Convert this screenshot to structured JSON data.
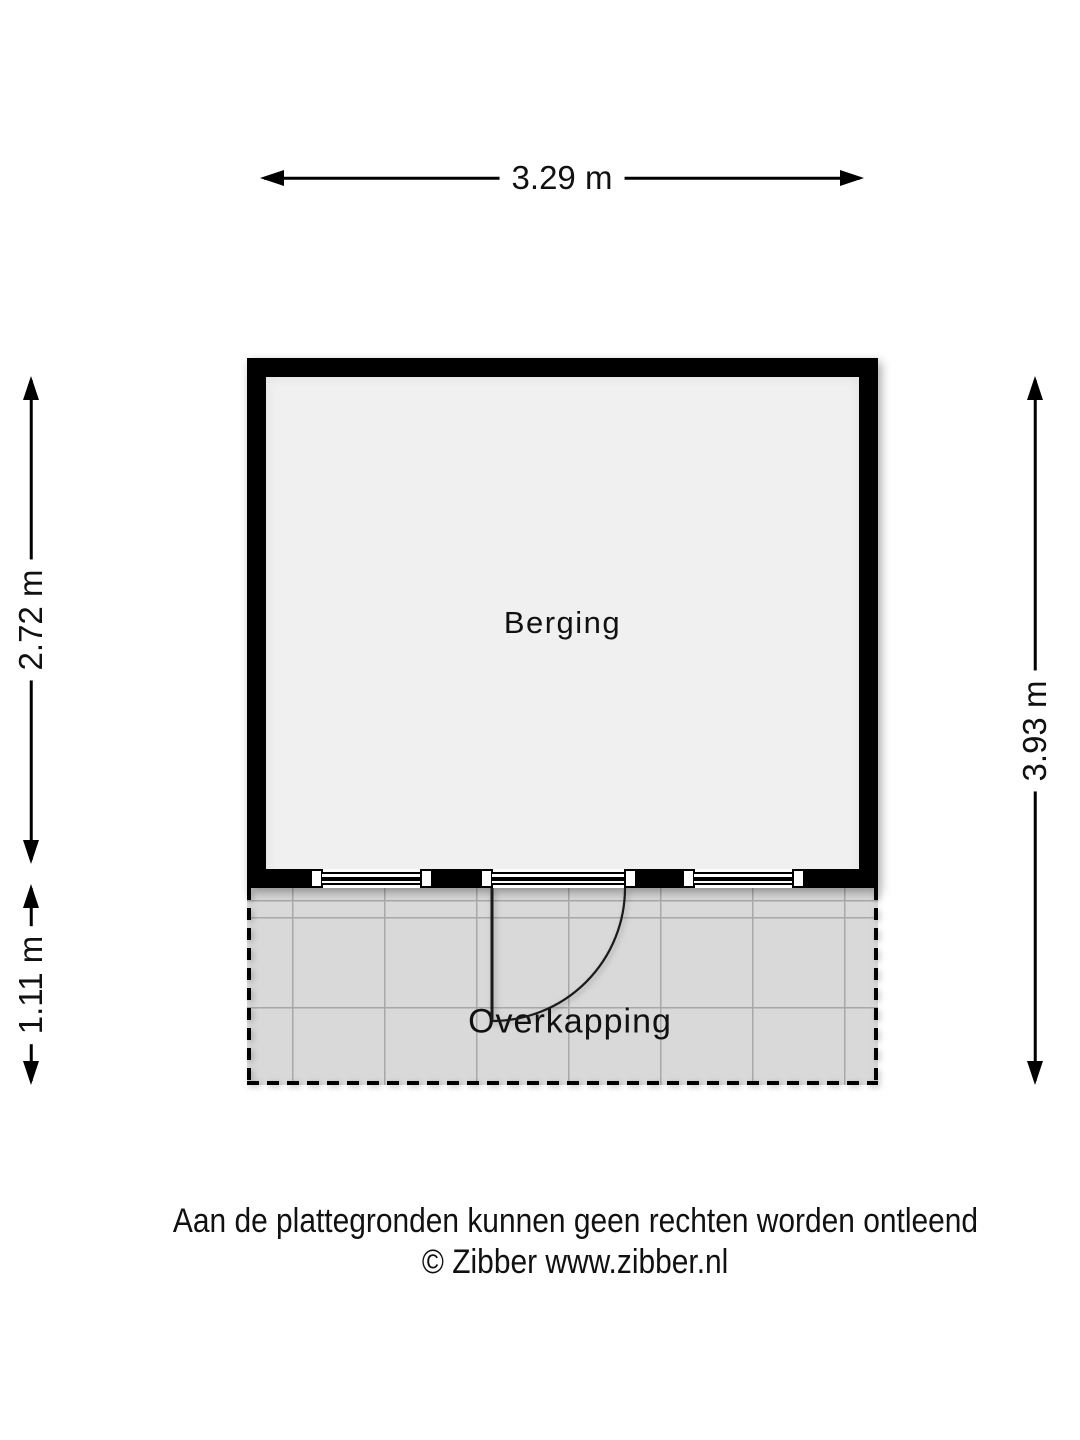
{
  "plan": {
    "rooms": [
      {
        "name": "Berging"
      },
      {
        "name": "Overkapping"
      }
    ],
    "dimensions": {
      "top": "3.29 m",
      "left_upper": "2.72 m",
      "left_lower": "1.11 m",
      "right": "3.93 m"
    }
  },
  "footer": {
    "disclaimer": "Aan de plattegronden kunnen geen rechten worden ontleend",
    "copyright": "© Zibber www.zibber.nl"
  },
  "colors": {
    "wall": "#000000",
    "room_fill": "#f0f0f0",
    "canopy_fill": "#d9d9d9",
    "grid_line": "#a8a8a8",
    "text": "#111111",
    "background": "#ffffff"
  }
}
